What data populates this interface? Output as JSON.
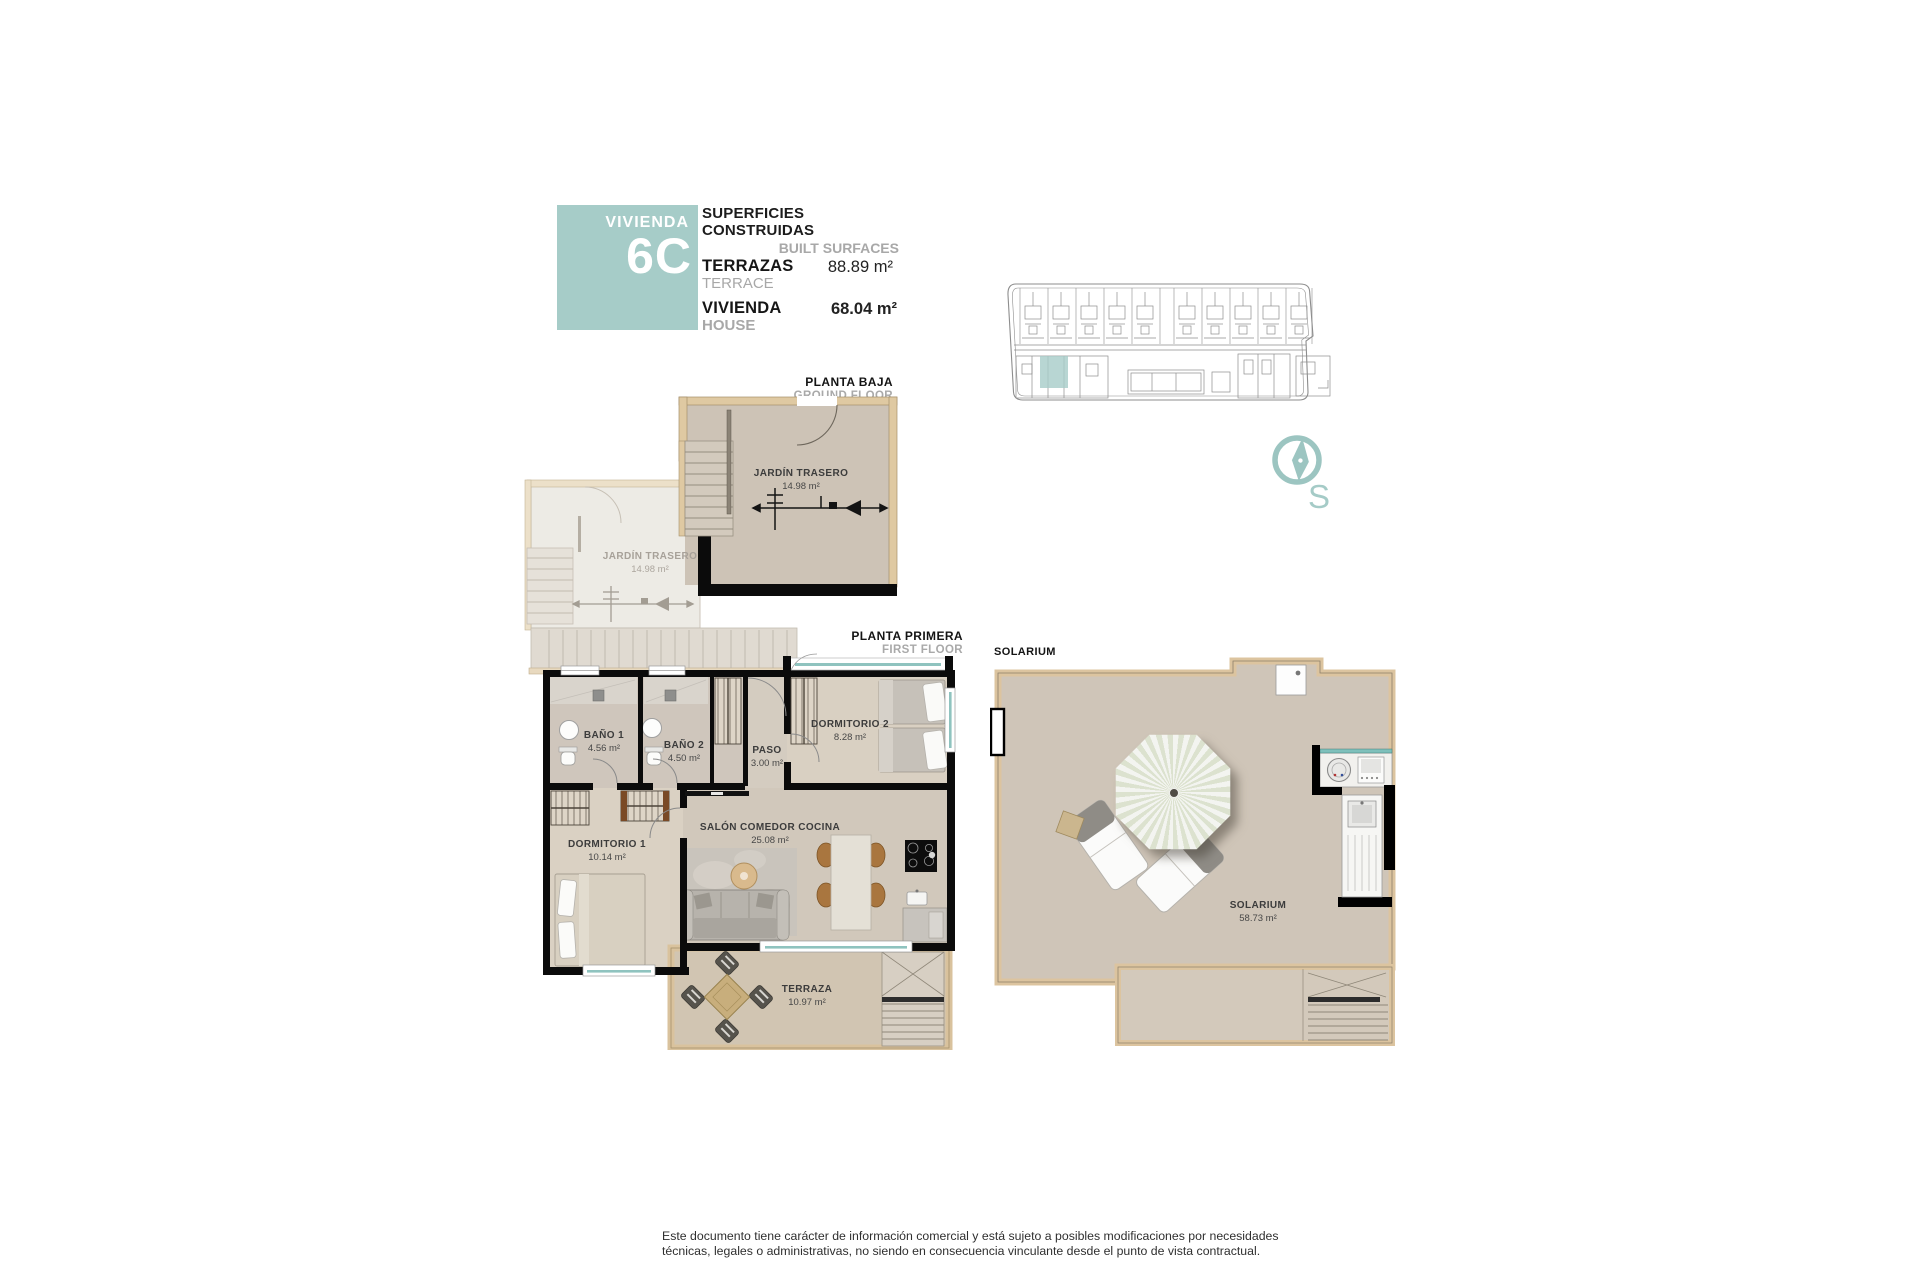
{
  "header": {
    "unit_label": "VIVIENDA",
    "unit_number": "6C",
    "title": "SUPERFICIES CONSTRUIDAS",
    "subtitle": "BUILT SURFACES",
    "rows": [
      {
        "label": "TERRAZAS",
        "sublabel": "TERRACE",
        "value": "88.89 m²"
      },
      {
        "label": "VIVIENDA",
        "sublabel": "HOUSE",
        "value": "68.04 m²"
      }
    ]
  },
  "ground_floor": {
    "label": "PLANTA BAJA",
    "sublabel": "GROUND FLOOR",
    "unit_room": {
      "name": "JARDÍN TRASERO",
      "area": "14.98 m²"
    },
    "adjacent_room": {
      "name": "JARDÍN TRASERO",
      "area": "14.98 m²"
    }
  },
  "first_floor": {
    "label": "PLANTA PRIMERA",
    "sublabel": "FIRST FLOOR",
    "rooms": {
      "bano1": {
        "name": "BAÑO 1",
        "area": "4.56 m²"
      },
      "bano2": {
        "name": "BAÑO 2",
        "area": "4.50 m²"
      },
      "paso": {
        "name": "PASO",
        "area": "3.00 m²"
      },
      "dorm2": {
        "name": "DORMITORIO 2",
        "area": "8.28 m²"
      },
      "dorm1": {
        "name": "DORMITORIO 1",
        "area": "10.14 m²"
      },
      "salon": {
        "name": "SALÓN COMEDOR COCINA",
        "area": "25.08 m²"
      },
      "terraza": {
        "name": "TERRAZA",
        "area": "10.97 m²"
      }
    }
  },
  "solarium": {
    "label": "SOLARIUM",
    "room": {
      "name": "SOLARIUM",
      "area": "58.73 m²"
    }
  },
  "compass": {
    "south_label": "S"
  },
  "footer": {
    "line1": "Este documento tiene carácter de información comercial y está sujeto a posibles modificaciones por necesidades",
    "line2": "técnicas, legales o administrativas, no siendo en consecuencia vinculante desde el punto de vista contractual."
  },
  "colors": {
    "accent_teal": "#a6ccc8",
    "wood": "#dcc49f",
    "wall": "#0b0b0b",
    "floor": "#cfc5b8"
  }
}
